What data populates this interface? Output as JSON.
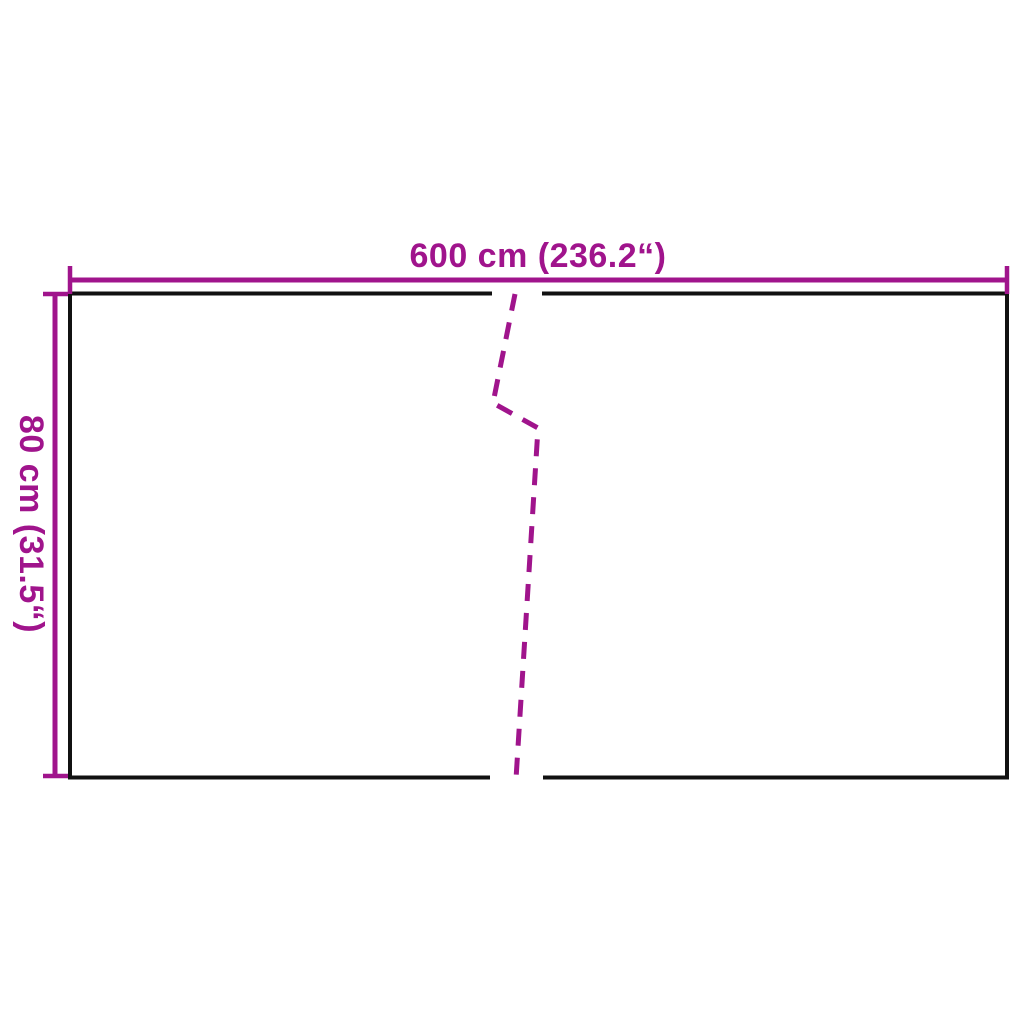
{
  "diagram": {
    "kind": "product-dimension-diagram",
    "width_label": "600 cm (236.2“)",
    "height_label": "80 cm (31.5“)",
    "width_cm": 600,
    "width_inches": 236.2,
    "height_cm": 80,
    "height_inches": 31.5
  },
  "colors": {
    "dimension": "#A0148C",
    "outline": "#111111",
    "background": "#FFFFFF"
  }
}
